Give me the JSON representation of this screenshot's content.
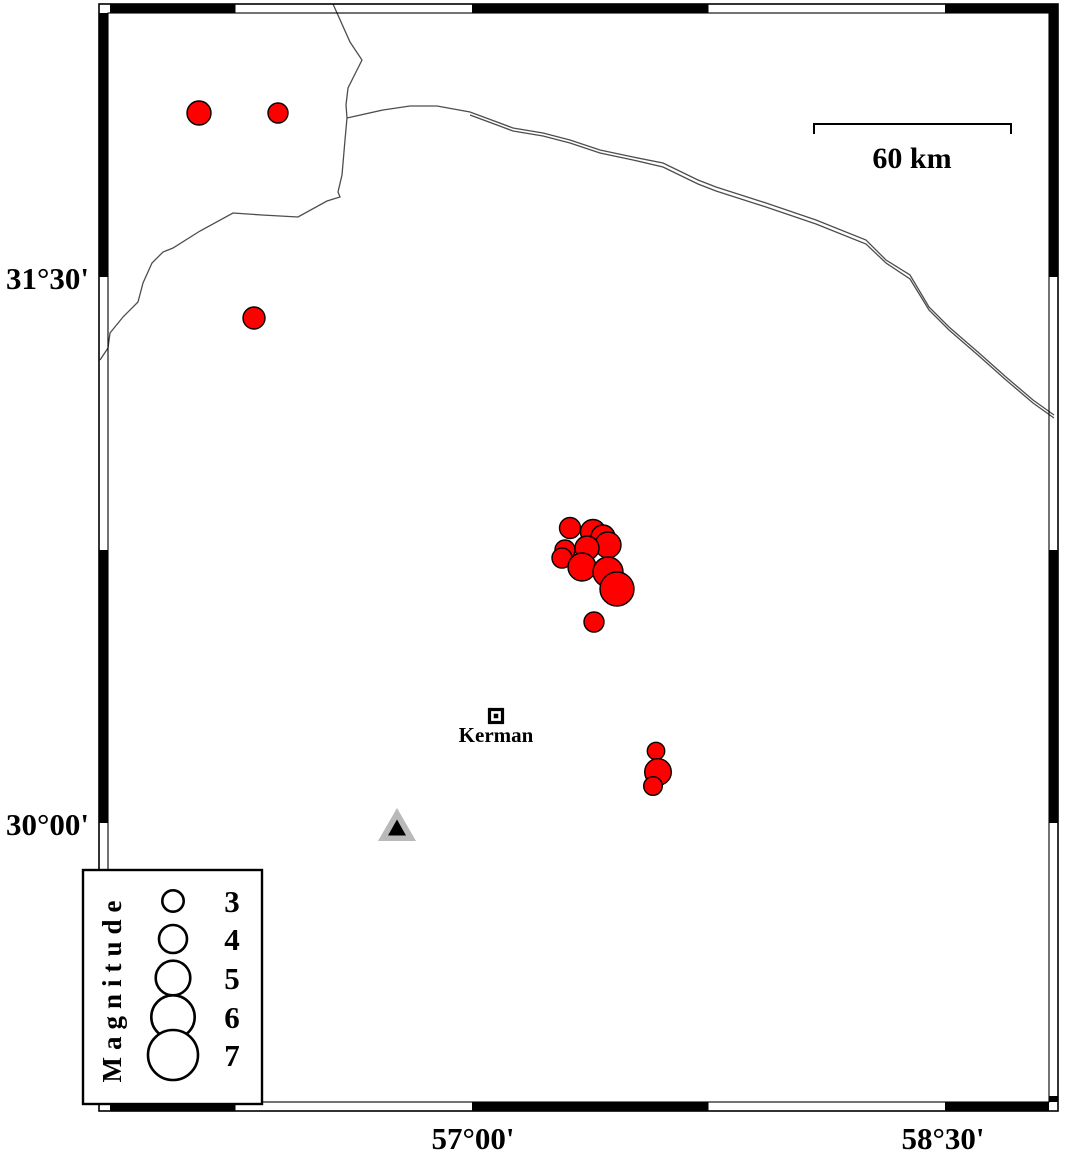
{
  "title": "Kerman region seismicity map",
  "colors": {
    "background": "#ffffff",
    "epicenter_fill": "#ff0000",
    "stroke": "#000000",
    "boundary_line": "#4d4d4d",
    "station_outer": "#b9b9b9",
    "station_inner": "#000000"
  },
  "frame": {
    "outer": {
      "x": 99,
      "y": 4,
      "w": 959,
      "h": 1107
    },
    "thickness": 9,
    "top_black": [
      [
        110,
        235.5
      ],
      [
        472,
        708.5
      ],
      [
        945,
        1058
      ]
    ],
    "bottom_black": [
      [
        110,
        235.5
      ],
      [
        472,
        708.5
      ],
      [
        945,
        1049
      ]
    ],
    "left_black": [
      [
        13,
        277
      ],
      [
        550,
        823
      ],
      [
        1096,
        1102
      ]
    ],
    "right_black": [
      [
        13,
        277
      ],
      [
        550,
        823
      ],
      [
        1096,
        1102
      ]
    ]
  },
  "axis": {
    "left_labels": [
      {
        "text": "31°30'",
        "x": 89,
        "y": 289
      },
      {
        "text": "30°00'",
        "x": 89,
        "y": 835
      }
    ],
    "bottom_labels": [
      {
        "text": "57°00'",
        "x": 473,
        "y": 1149
      },
      {
        "text": "58°30'",
        "x": 943,
        "y": 1149
      }
    ]
  },
  "scale_bar": {
    "label": "60 km",
    "x1": 814,
    "x2": 1011,
    "y": 124,
    "tick": 10,
    "label_x": 912,
    "label_y": 168
  },
  "city": {
    "name": "Kerman",
    "x": 496,
    "y": 716,
    "size": 13,
    "dot": 4.5,
    "label_x": 496,
    "label_y": 742
  },
  "station": {
    "outer": [
      [
        397,
        808
      ],
      [
        378,
        841
      ],
      [
        416,
        841
      ]
    ],
    "inner": [
      [
        397,
        819.5
      ],
      [
        388,
        835.5
      ],
      [
        406,
        835.5
      ]
    ]
  },
  "boundary_lines": [
    {
      "name": "border-line-west",
      "points": [
        [
          333,
          4
        ],
        [
          350,
          42
        ],
        [
          362,
          60
        ],
        [
          356,
          72
        ],
        [
          348,
          88
        ],
        [
          346,
          105
        ],
        [
          347,
          118
        ],
        [
          345,
          140
        ],
        [
          342,
          175
        ],
        [
          338,
          192
        ],
        [
          340,
          197
        ],
        [
          327,
          201
        ],
        [
          298,
          217
        ],
        [
          262,
          215
        ],
        [
          233,
          213
        ],
        [
          200,
          231
        ],
        [
          173,
          248
        ],
        [
          163,
          252
        ],
        [
          152,
          263
        ],
        [
          143,
          283
        ],
        [
          138,
          302
        ],
        [
          123,
          317
        ],
        [
          110,
          333
        ],
        [
          108,
          348
        ],
        [
          100,
          360
        ]
      ]
    },
    {
      "name": "border-line-northeast-upper",
      "points": [
        [
          347,
          118
        ],
        [
          383,
          110
        ],
        [
          410,
          106
        ],
        [
          437,
          106
        ],
        [
          470,
          112
        ],
        [
          497,
          122
        ],
        [
          513,
          128
        ],
        [
          543,
          133
        ],
        [
          570,
          140
        ],
        [
          600,
          150
        ],
        [
          633,
          157
        ],
        [
          663,
          163
        ],
        [
          698,
          180
        ],
        [
          716,
          187
        ],
        [
          766,
          203
        ],
        [
          816,
          220
        ],
        [
          866,
          240
        ],
        [
          886,
          260
        ],
        [
          910,
          275
        ],
        [
          929,
          307
        ],
        [
          949,
          327
        ],
        [
          979,
          353
        ],
        [
          1006,
          377
        ],
        [
          1033,
          400
        ],
        [
          1054,
          415
        ]
      ]
    },
    {
      "name": "border-line-northeast-lower",
      "points": [
        [
          470,
          115
        ],
        [
          497,
          125
        ],
        [
          513,
          131
        ],
        [
          543,
          136
        ],
        [
          570,
          143
        ],
        [
          600,
          153
        ],
        [
          633,
          160
        ],
        [
          663,
          167
        ],
        [
          698,
          184
        ],
        [
          716,
          191
        ],
        [
          766,
          207
        ],
        [
          816,
          224
        ],
        [
          866,
          244
        ],
        [
          886,
          263
        ],
        [
          910,
          279
        ],
        [
          929,
          310
        ],
        [
          949,
          330
        ],
        [
          979,
          356
        ],
        [
          1006,
          380
        ],
        [
          1033,
          403
        ],
        [
          1054,
          418
        ]
      ]
    }
  ],
  "earthquakes": [
    {
      "cx": 199,
      "cy": 113,
      "r": 12,
      "magnitude_est": 3.4
    },
    {
      "cx": 278,
      "cy": 113,
      "r": 10,
      "magnitude_est": 2.8
    },
    {
      "cx": 254,
      "cy": 318,
      "r": 11,
      "magnitude_est": 3.1
    },
    {
      "cx": 570,
      "cy": 528,
      "r": 10.5,
      "magnitude_est": 2.9
    },
    {
      "cx": 593,
      "cy": 532,
      "r": 12.5,
      "magnitude_est": 3.5
    },
    {
      "cx": 603,
      "cy": 537,
      "r": 12,
      "magnitude_est": 3.4
    },
    {
      "cx": 608,
      "cy": 545,
      "r": 13,
      "magnitude_est": 3.7
    },
    {
      "cx": 587,
      "cy": 548,
      "r": 12,
      "magnitude_est": 3.4
    },
    {
      "cx": 565,
      "cy": 550,
      "r": 10,
      "magnitude_est": 2.8
    },
    {
      "cx": 562,
      "cy": 558,
      "r": 10,
      "magnitude_est": 2.8
    },
    {
      "cx": 582,
      "cy": 567,
      "r": 14,
      "magnitude_est": 4.0
    },
    {
      "cx": 608,
      "cy": 572,
      "r": 15,
      "magnitude_est": 4.3
    },
    {
      "cx": 617,
      "cy": 589,
      "r": 17,
      "magnitude_est": 4.9
    },
    {
      "cx": 594,
      "cy": 622,
      "r": 10,
      "magnitude_est": 2.8
    },
    {
      "cx": 656,
      "cy": 751,
      "r": 8.7,
      "magnitude_est": 2.4
    },
    {
      "cx": 658,
      "cy": 772,
      "r": 13.3,
      "magnitude_est": 3.8
    },
    {
      "cx": 653,
      "cy": 786,
      "r": 9.3,
      "magnitude_est": 2.6
    }
  ],
  "legend": {
    "box": {
      "x": 83,
      "y": 870,
      "w": 179,
      "h": 234
    },
    "title": "Magnitude",
    "title_x": 121,
    "title_y": 988,
    "circle_x": 173,
    "number_x": 232,
    "entries": [
      {
        "label": "3",
        "y": 901,
        "r": 10.7
      },
      {
        "label": "4",
        "y": 939,
        "r": 14
      },
      {
        "label": "5",
        "y": 978,
        "r": 17.3
      },
      {
        "label": "6",
        "y": 1017,
        "r": 21.7
      },
      {
        "label": "7",
        "y": 1055,
        "r": 25
      }
    ]
  }
}
